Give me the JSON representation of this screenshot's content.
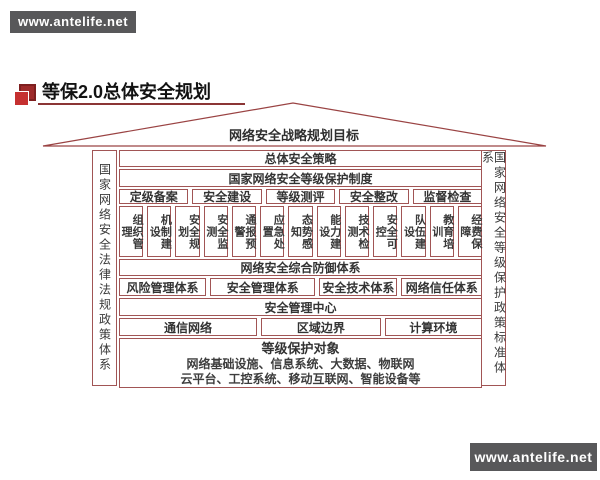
{
  "watermarks": {
    "top": "www.antelife.net",
    "bottom": "www.antelife.net"
  },
  "header": {
    "title": "等保2.0总体安全规划"
  },
  "house": {
    "roof_label": "网络安全战略规划目标",
    "left_wall": "国家网络安全法律法规政策体系",
    "right_wall": "国家网络安全等级保护政策标准体系",
    "row_overall_strategy": "总体安全策略",
    "row_protection_system": "国家网络安全等级保护制度",
    "process_cells": [
      "定级备案",
      "安全建设",
      "等级测评",
      "安全整改",
      "监督检查"
    ],
    "capability_cells": [
      "组织管理",
      "机制建设",
      "安全规划",
      "安全监测",
      "通报预警",
      "应急处置",
      "态势感知",
      "能力建设",
      "技术检测",
      "安全可控",
      "队伍建设",
      "教育培训",
      "经费保障"
    ],
    "row_defense_system": "网络安全综合防御体系",
    "system_cells": [
      "风险管理体系",
      "安全管理体系",
      "安全技术体系",
      "网络信任体系"
    ],
    "row_management_center": "安全管理中心",
    "environment_cells": [
      "通信网络",
      "区域边界",
      "计算环境"
    ],
    "protected_objects": {
      "title": "等级保护对象",
      "line1": "网络基础设施、信息系统、大数据、物联网",
      "line2": "云平台、工控系统、移动互联网、智能设备等"
    }
  },
  "colors": {
    "line": "#a15555",
    "roof_stroke": "#9a4343",
    "banner_bg": "#58585a",
    "accent_red": "#c53030",
    "underline": "#8b3535"
  }
}
